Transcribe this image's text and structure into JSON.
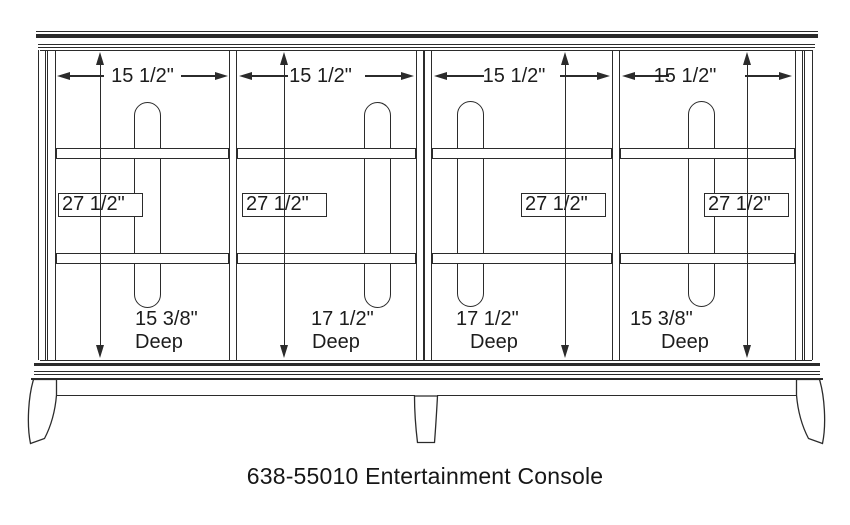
{
  "title": "638-55010 Entertainment Console",
  "bays": [
    {
      "width": "15 1/2\"",
      "height": "27 1/2\"",
      "depth": "15 3/8\"",
      "depth_unit": "Deep"
    },
    {
      "width": "15 1/2\"",
      "height": "27 1/2\"",
      "depth": "17 1/2\"",
      "depth_unit": "Deep"
    },
    {
      "width": "15 1/2\"",
      "height": "27 1/2\"",
      "depth": "17 1/2\"",
      "depth_unit": "Deep"
    },
    {
      "width": "15 1/2\"",
      "height": "27 1/2\"",
      "depth": "15 3/8\"",
      "depth_unit": "Deep"
    }
  ],
  "colors": {
    "line": "#2b2b2b",
    "background": "#ffffff"
  }
}
